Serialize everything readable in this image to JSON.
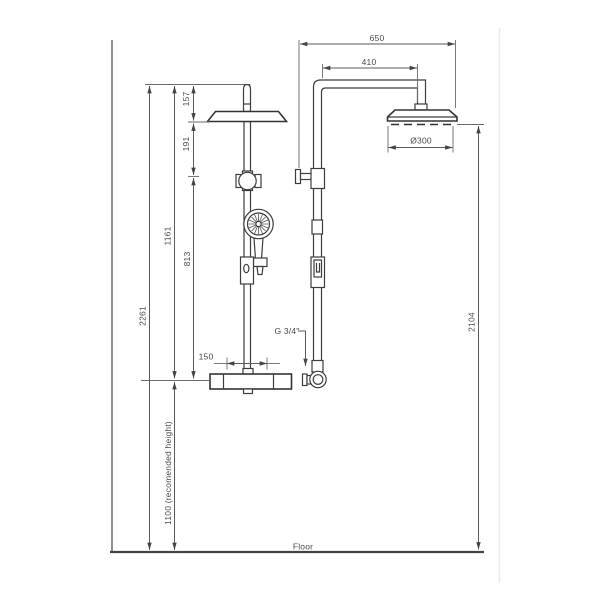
{
  "drawing": {
    "type": "technical-dimension-drawing",
    "subject": "shower column front and side elevation",
    "floor_label": "Floor",
    "connection_label": "G 3/4\"",
    "dimensions": {
      "total_height": "2261",
      "top_to_valve": "1161",
      "valve_to_floor": "1100 (recomended height)",
      "top_to_head": "157",
      "head_to_slider": "191",
      "slider_to_valve": "813",
      "wall_to_head_edge": "650",
      "arm_projection": "410",
      "head_diameter": "Ø300",
      "supply_centres": "150",
      "head_to_floor": "2104"
    }
  }
}
